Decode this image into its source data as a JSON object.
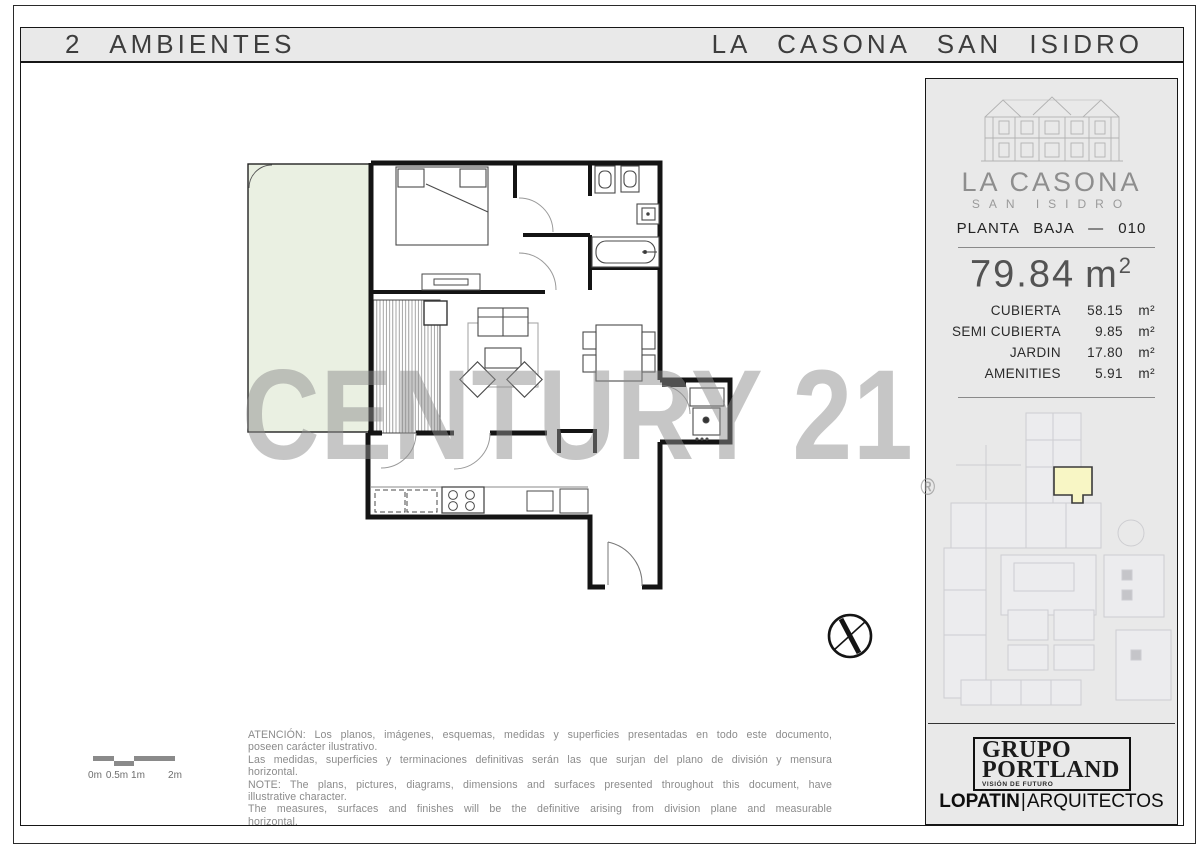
{
  "header": {
    "left": "2 AMBIENTES",
    "right": "LA CASONA SAN ISIDRO"
  },
  "sidebar": {
    "brand": {
      "name": "LA CASONA",
      "subname": "SAN ISIDRO"
    },
    "plan_label": "PLANTA BAJA — 010",
    "total": {
      "value": "79.84",
      "unit_base": "m",
      "unit_sup": "2"
    },
    "areas": [
      {
        "label": "CUBIERTA",
        "value": "58.15",
        "unit": "m²"
      },
      {
        "label": "SEMI CUBIERTA",
        "value": "9.85",
        "unit": "m²"
      },
      {
        "label": "JARDIN",
        "value": "17.80",
        "unit": "m²"
      },
      {
        "label": "AMENITIES",
        "value": "5.91",
        "unit": "m²"
      }
    ],
    "developer": {
      "line1": "GRUPO",
      "line2": "PORTLAND",
      "tagline": "VISIÓN DE FUTURO"
    },
    "architect": {
      "name": "LOPATIN",
      "sep": "|",
      "type": "ARQUITECTOS"
    }
  },
  "watermark": {
    "text": "CENTURY 21",
    "reg": "®"
  },
  "scalebar": {
    "labels": [
      "0m",
      "0.5m",
      "1m",
      "2m"
    ]
  },
  "disclaimer": {
    "lines": [
      "ATENCIÓN: Los planos, imágenes, esquemas, medidas y superficies presentadas en todo este documento,",
      "poseen carácter ilustrativo.",
      "Las medidas, superficies y terminaciones definitivas serán las que surjan del plano de división y mensura",
      "horizontal.",
      "NOTE: The plans, pictures, diagrams, dimensions and surfaces presented throughout this document, have",
      "illustrative character.",
      "The measures, surfaces and finishes will be the definitive arising from division plane and measurable",
      "horizontal."
    ]
  },
  "colors": {
    "panel_gray": "#e9e9e9",
    "garden_green": "#eaf0e2",
    "highlight_yellow": "#f8f6c5",
    "watermark_gray": "#8d8d8d",
    "wall_black": "#141414",
    "faint_map_line": "#c9c9cd"
  }
}
